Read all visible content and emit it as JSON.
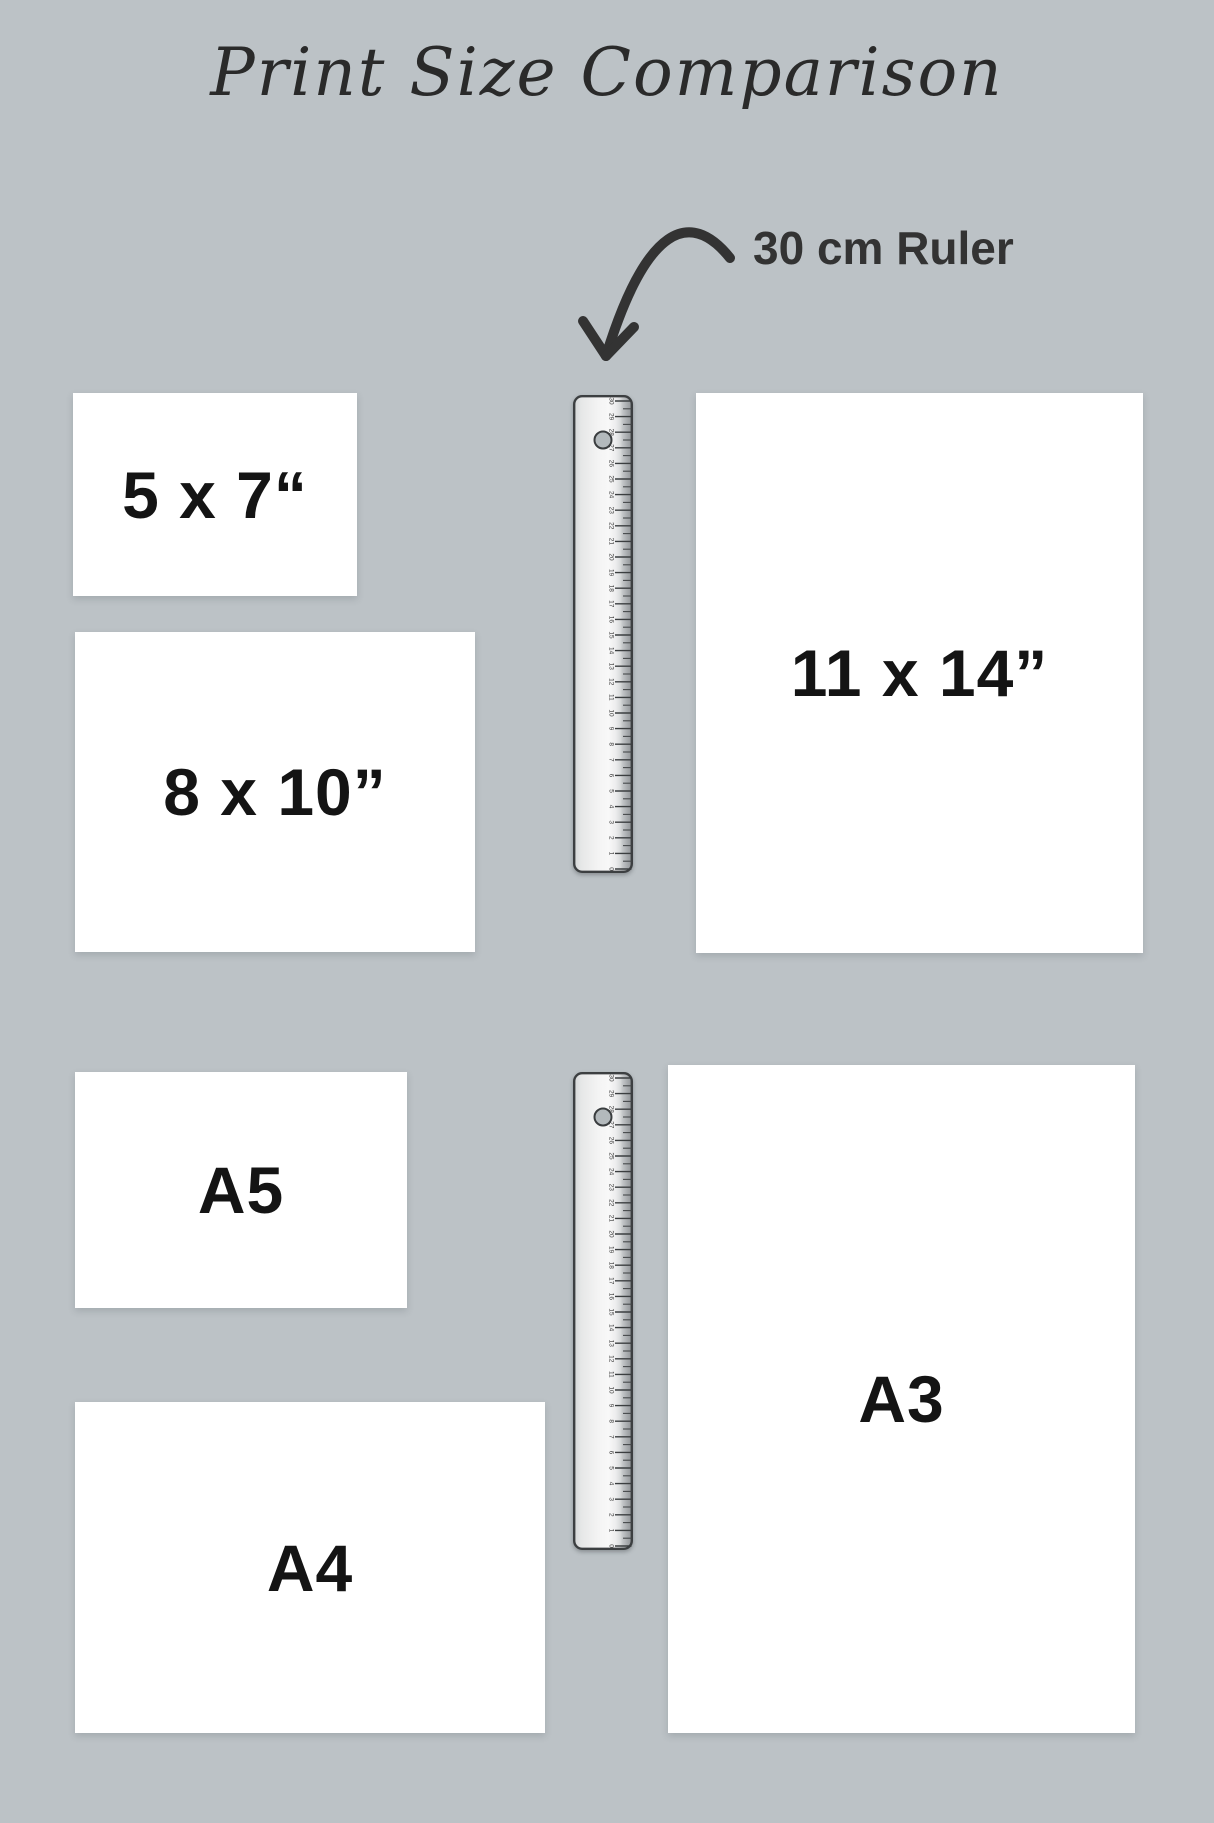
{
  "title": "Print Size Comparison",
  "annotation": {
    "ruler_label": "30 cm Ruler"
  },
  "colors": {
    "background": "#bcc2c6",
    "paper": "#ffffff",
    "ink": "#333333",
    "label_text": "#141414",
    "ruler_border": "#3c3f41"
  },
  "print_sizes": [
    {
      "id": "5x7",
      "label": "5 x 7“",
      "x": 73,
      "y": 393,
      "w": 284,
      "h": 203
    },
    {
      "id": "8x10",
      "label": "8 x 10”",
      "x": 75,
      "y": 632,
      "w": 400,
      "h": 320
    },
    {
      "id": "11x14",
      "label": "11 x 14”",
      "x": 696,
      "y": 393,
      "w": 447,
      "h": 560
    },
    {
      "id": "a5",
      "label": "A5",
      "x": 75,
      "y": 1072,
      "w": 332,
      "h": 236
    },
    {
      "id": "a4",
      "label": "A4",
      "x": 75,
      "y": 1402,
      "w": 470,
      "h": 331
    },
    {
      "id": "a3",
      "label": "A3",
      "x": 668,
      "y": 1065,
      "w": 467,
      "h": 668
    }
  ],
  "rulers": [
    {
      "id": "ruler-top",
      "x": 573,
      "y": 395,
      "w": 60,
      "h": 478,
      "max_cm": 30
    },
    {
      "id": "ruler-bottom",
      "x": 573,
      "y": 1072,
      "w": 60,
      "h": 478,
      "max_cm": 30
    }
  ]
}
